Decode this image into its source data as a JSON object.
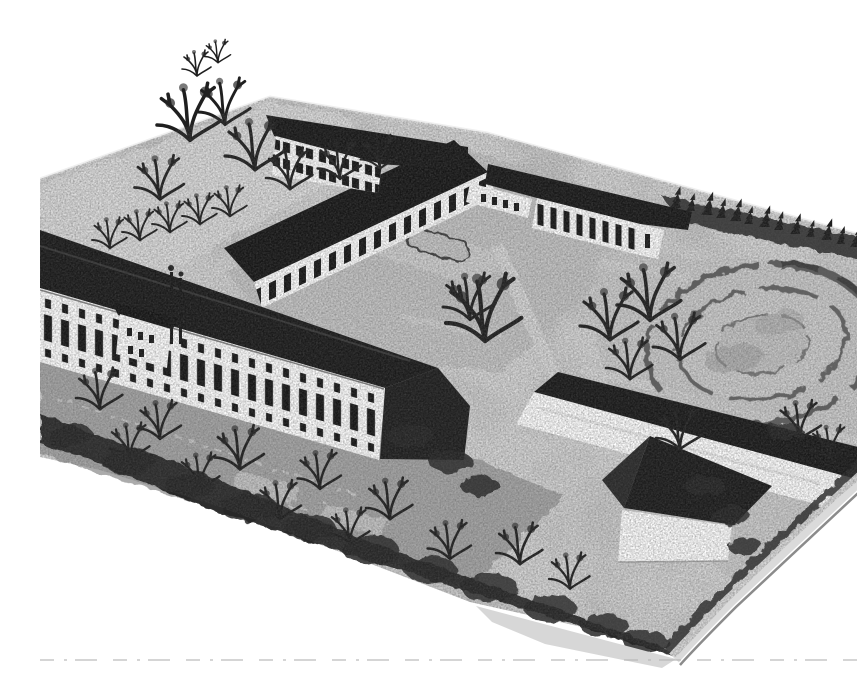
{
  "scene": {
    "media": "black-and-white halftone photograph",
    "subject": "Bird's-eye view of an architectural scale model of a school campus with courtyard gardens, tree rows, an oval sports field, orchard plots and outbuildings",
    "labels": {
      "base": "Model base board",
      "rim": "Beveled edge of the model base",
      "north_building": "Two-storey north building",
      "wing": "Long connecting wing with dark pitched roof",
      "connector": "Low connecting block",
      "east_building": "Single-storey east building",
      "main_building": "Main school building with tall windows",
      "bay": "Projecting gabled bay of the main building",
      "flagpoles": "Flag poles in front of the main building",
      "south_building": "South outbuilding with plain white wall",
      "barn": "Gabled barn with white gable end",
      "oval_field": "Oval sports field with surrounding track",
      "conifer_row": "Row of conifers along the north-east boundary",
      "boundary_hedge": "Dark boundary hedge along the south-west edge",
      "orchard": "Orchard and garden plots",
      "courtyard": "Central courtyard with parterre flower beds",
      "central_tree": "Large free-standing tree in the courtyard",
      "tree_clusters": "Clusters of bare deciduous trees",
      "paths": "Light gravel paths",
      "fold_line": "Faint dashed line along the bottom margin"
    },
    "palette": {
      "paper": "#ffffff",
      "ground_light": "#e0e0e0",
      "ground_mid": "#c6c6c6",
      "ground_dark": "#a2a2a2",
      "hedge": "#242424",
      "roof": "#181818",
      "facade": "#ffffff",
      "window": "#161616",
      "rim": "#dadada",
      "track_line": "#4d4d4d"
    }
  }
}
